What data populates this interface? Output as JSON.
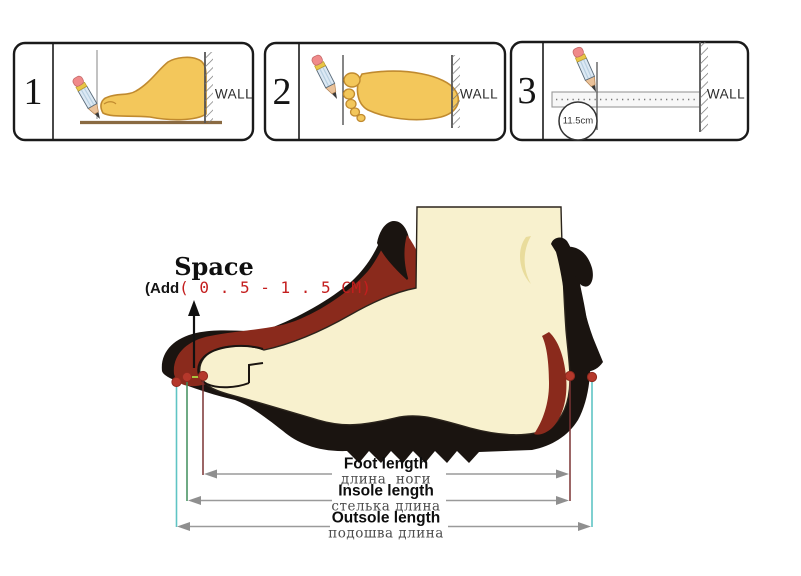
{
  "figure": {
    "panels": [
      {
        "number": "1",
        "wall_label": "WALL"
      },
      {
        "number": "2",
        "wall_label": "WALL"
      },
      {
        "number": "3",
        "wall_label": "WALL",
        "ruler_reading": "11.5cm"
      }
    ],
    "space_note": {
      "title": "Space",
      "prefix": "(Add",
      "range": "( 0 . 5 - 1 . 5 CM)"
    },
    "measurements": [
      {
        "en": "Foot length",
        "ru": "длина  ноги"
      },
      {
        "en": "Insole length",
        "ru": "стелька длина"
      },
      {
        "en": "Outsole length",
        "ru": "подошва длина"
      }
    ],
    "icons": {
      "pencil": "pencil-icon",
      "wall_hatch": "wall-hatch-icon",
      "ruler": "ruler-icon",
      "measure_arrow": "measure-arrow-icon"
    },
    "colors": {
      "boot_black": "#1a1410",
      "lining_maroon": "#8a2a1c",
      "foot_cream": "#f8f1ce",
      "marker_dot_red": "#b5382b",
      "outsole_line_cyan": "#5fc4c4",
      "insole_line_green": "#3f8d5a",
      "foot_line_maroon": "#7b3333",
      "measure_line_gray": "#9a9a9a",
      "range_text_red": "#c41e1e",
      "panel_foot_gold": "#f3c75b",
      "floor_brown": "#8a6a42"
    }
  }
}
